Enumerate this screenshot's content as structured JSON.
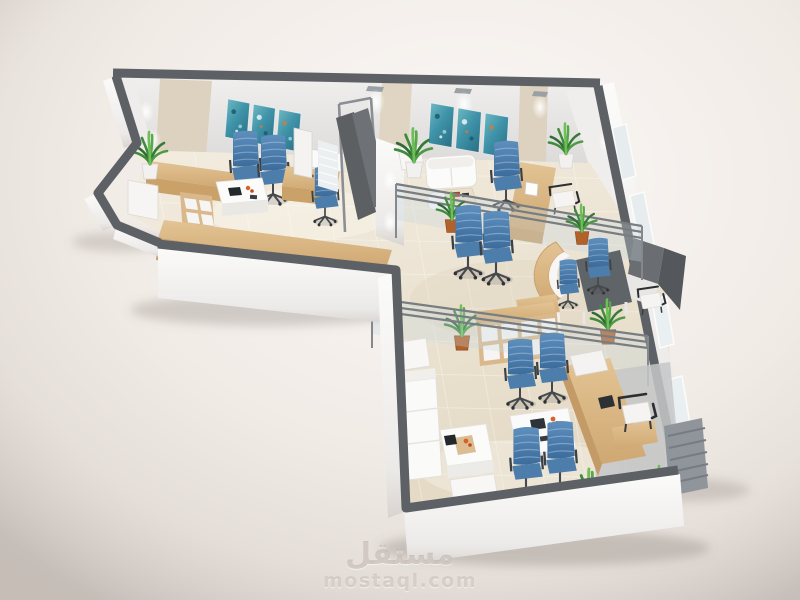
{
  "image": {
    "type": "3d-architectural-render",
    "subject": "Isometric cutaway floor plan of an L-shaped office interior",
    "style": "photorealistic dollhouse view on light studio background"
  },
  "watermark": {
    "logo": "مستقل",
    "url": "mostaql.com"
  },
  "palette": {
    "background": "#efe9e4",
    "wall_top": "#5d6165",
    "wall_face": "#f7f6f5",
    "back_wall": "#e9e8e7",
    "beige_panel": "#dcd1bf",
    "floor": "#ece4d4",
    "wood": "#d9b98c",
    "wood_dark": "#c49a66",
    "chair_blue": "#4a7aa8",
    "white_furniture": "#fafaf8",
    "glass": "#cdd9e0",
    "glass_rail": "#787d81",
    "plant_green": "#3f8a3c",
    "terracotta_pot": "#b0622a",
    "art_teal": "#3f93a8",
    "charcoal_desk": "#5f6468",
    "rug_gray": "#c4c7c8",
    "watermark_gray": "#c9beb6"
  },
  "scene": {
    "rooms": [
      {
        "name": "reception-office",
        "items": [
          "teal wall art triptych",
          "two blue guest chairs",
          "white coffee table",
          "L-shaped wood counter with cubby shelves",
          "alcove cabinet with plant",
          "staff desk with blue chair",
          "privacy screen panels"
        ]
      },
      {
        "name": "lounge-office",
        "items": [
          "teal wall art triptych",
          "white sofa set",
          "wood coffee table",
          "potted plants",
          "wood staff desk with monitor",
          "blue office chair",
          "black guest chair",
          "glass partition"
        ]
      },
      {
        "name": "open-corridor",
        "items": [
          "curved wood reception desk",
          "charcoal desk",
          "blue office chairs",
          "wood cubby bookshelf",
          "terracotta potted plants",
          "glass balustrades"
        ]
      },
      {
        "name": "executive-meeting-room",
        "items": [
          "white meeting table",
          "four blue chairs",
          "angled wood executive desk",
          "white guest chairs with black frames",
          "white sofa and armchair",
          "white coffee table with tablet and red flowers",
          "gray rug",
          "window blinds",
          "potted plants"
        ]
      }
    ]
  }
}
